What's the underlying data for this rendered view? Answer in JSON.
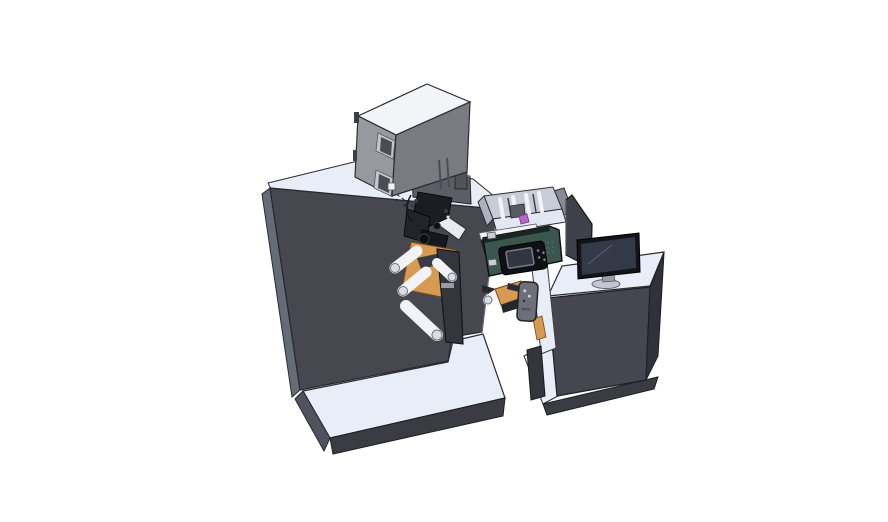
{
  "scene": {
    "description": "Isometric 3D CAD render of a label printing / coding machine line: large dark cabinet with grey coder box and signal beacon on top, web rollers and orange brackets, teal thermal printer unit with control screen, open component tray, and an operator desk with a monitor, all on light base plates",
    "background": "#ffffff",
    "colors": {
      "outline": "#2b2c32",
      "machine_front": "#46474f",
      "machine_side": "#666b78",
      "surface_light": "#e9edf7",
      "base_side": "#50535d",
      "base_edge_dark": "#3a3b43",
      "box_top": "#f2f4f8",
      "box_left": "#97999f",
      "box_front": "#7a7b81",
      "window_frame": "#c3c6cd",
      "window_glass": "#4b4d54",
      "rear_block": "#5c5d66",
      "rear_block_top": "#858894",
      "beacon_body": "#51535b",
      "beacon_cap": "#3b3c42",
      "teal_printer": "#3b554f",
      "teal_dark": "#1a2522",
      "panel_black": "#101114",
      "screen_gray": "#31353f",
      "screen_border": "#767b86",
      "orange_bracket": "#d79a52",
      "orange_edge": "#6f4a20",
      "roller_white": "#f1f3f7",
      "roller_cap": "#dadde4",
      "column_dark": "#34353d",
      "remote_gray": "#6e7079",
      "slab_gray": "#878a94",
      "chamber_wall": "#c8ccd7",
      "chamber_wall_dark": "#aeb2bf",
      "chamber_floor": "#e3e7f1",
      "chamber_front_dark": "#2e2f36",
      "magenta_part": "#b765c5",
      "desk_front": "#45464f",
      "desk_side": "#303139",
      "divider_panel": "#3e414a",
      "monitor_bezel": "#131419",
      "monitor_screen": "#343947",
      "monitor_stand": "#9aa0ab",
      "monitor_base": "#c2c7d1",
      "mech_black": "#1c1d22",
      "mech_black2": "#232429",
      "mech_black3": "#17181d",
      "rail_silver": "#e8ebf2",
      "button_dot": "#7a7e87",
      "vent_dot": "#5d6d67",
      "label_plate": "#979ba5",
      "dark_part": "#26272d"
    },
    "parts": [
      {
        "id": "machine-cabinet",
        "label": "main machine cabinet"
      },
      {
        "id": "coder-box",
        "label": "grey coder/laser box on top"
      },
      {
        "id": "signal-beacon",
        "label": "signal beacon cylinder"
      },
      {
        "id": "print-mechanism",
        "label": "black print mechanism cluster"
      },
      {
        "id": "web-rollers",
        "label": "white web guide rollers"
      },
      {
        "id": "orange-brackets",
        "label": "orange mounting brackets"
      },
      {
        "id": "thermal-printer",
        "label": "teal printer unit with control screen"
      },
      {
        "id": "component-tray",
        "label": "open component tray with rollers"
      },
      {
        "id": "sensor-remote",
        "label": "grey sensor/remote unit"
      },
      {
        "id": "operator-desk",
        "label": "operator desk cabinet"
      },
      {
        "id": "monitor",
        "label": "desktop monitor"
      },
      {
        "id": "divider-screen",
        "label": "dark divider panel"
      },
      {
        "id": "base-plates",
        "label": "light machine base plates"
      }
    ]
  }
}
